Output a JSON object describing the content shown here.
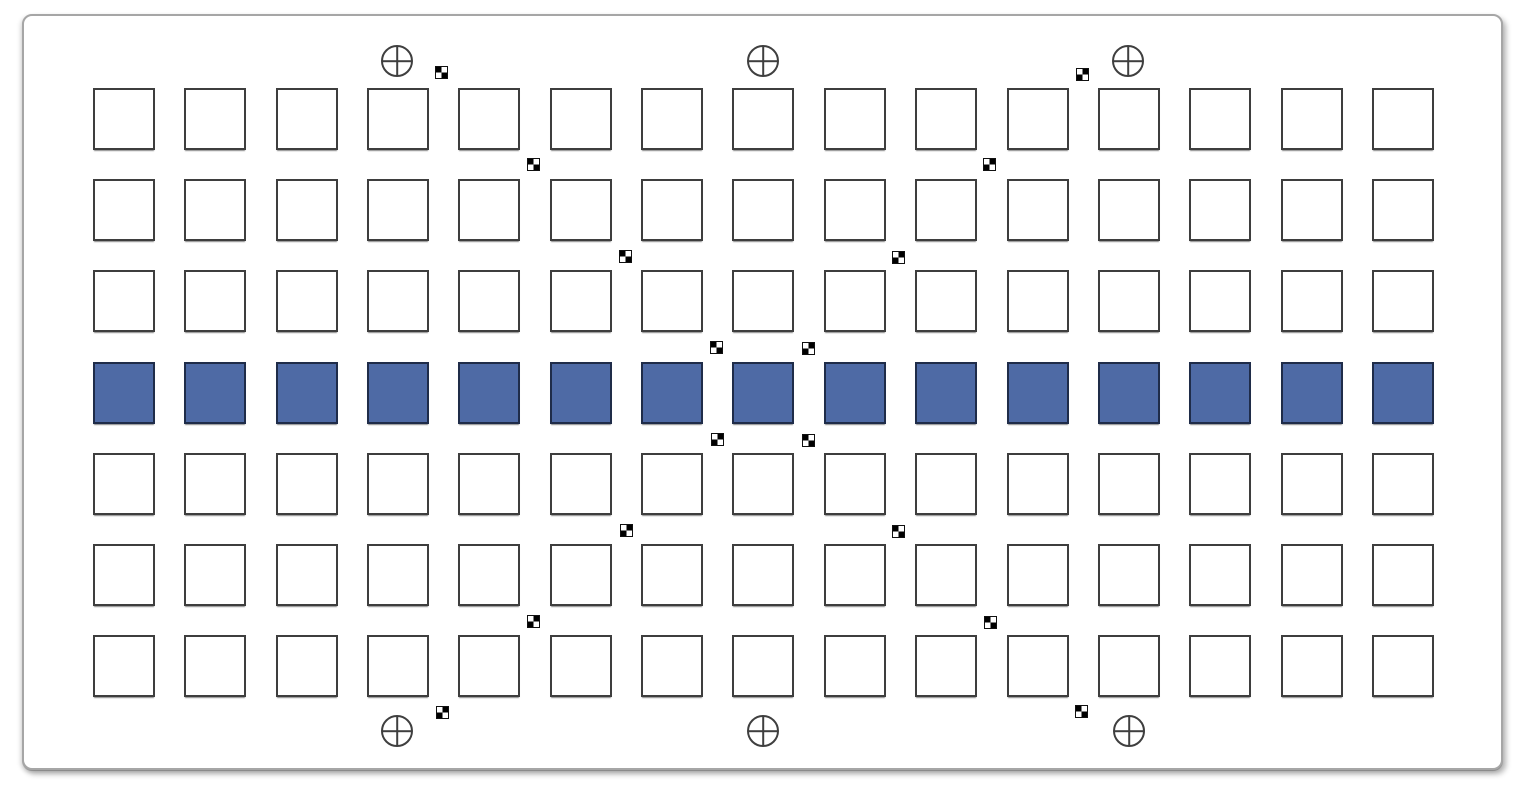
{
  "canvas": {
    "width": 1524,
    "height": 796,
    "background": "#ffffff"
  },
  "panel": {
    "x": 22,
    "y": 14,
    "width": 1481,
    "height": 756,
    "corner_radius": 10,
    "border_width": 2,
    "border_color": "#a6a6a6",
    "fill": "#ffffff"
  },
  "grid": {
    "columns": 15,
    "rows": 7,
    "origin_x": 93,
    "origin_y": 88,
    "cell_size": 62,
    "pitch_x": 91.35,
    "pitch_y": 91.2,
    "cell_fill": "#ffffff",
    "cell_border_color": "#3e3e3e",
    "highlight_row_index": 3,
    "highlight_fill": "#4e6aa5",
    "highlight_border_color": "#1f2c49"
  },
  "fiducial_circles": {
    "radius": 16,
    "stroke_color": "#3f3f3f",
    "positions": [
      {
        "x": 397,
        "y": 61
      },
      {
        "x": 763,
        "y": 61
      },
      {
        "x": 1128,
        "y": 61
      },
      {
        "x": 397,
        "y": 731
      },
      {
        "x": 763,
        "y": 731
      },
      {
        "x": 1129,
        "y": 731
      }
    ]
  },
  "checker_markers": {
    "size": 11,
    "color_dark": "#000000",
    "color_light": "#ffffff",
    "diagonal_down": [
      {
        "x": 441,
        "y": 72
      },
      {
        "x": 533,
        "y": 164
      },
      {
        "x": 625,
        "y": 256
      },
      {
        "x": 716,
        "y": 347
      },
      {
        "x": 808,
        "y": 440
      },
      {
        "x": 898,
        "y": 531
      },
      {
        "x": 990,
        "y": 622
      },
      {
        "x": 1081,
        "y": 711
      }
    ],
    "diagonal_up": [
      {
        "x": 1082,
        "y": 74
      },
      {
        "x": 989,
        "y": 164
      },
      {
        "x": 898,
        "y": 257
      },
      {
        "x": 808,
        "y": 348
      },
      {
        "x": 717,
        "y": 439
      },
      {
        "x": 626,
        "y": 530
      },
      {
        "x": 533,
        "y": 621
      },
      {
        "x": 442,
        "y": 712
      }
    ]
  }
}
